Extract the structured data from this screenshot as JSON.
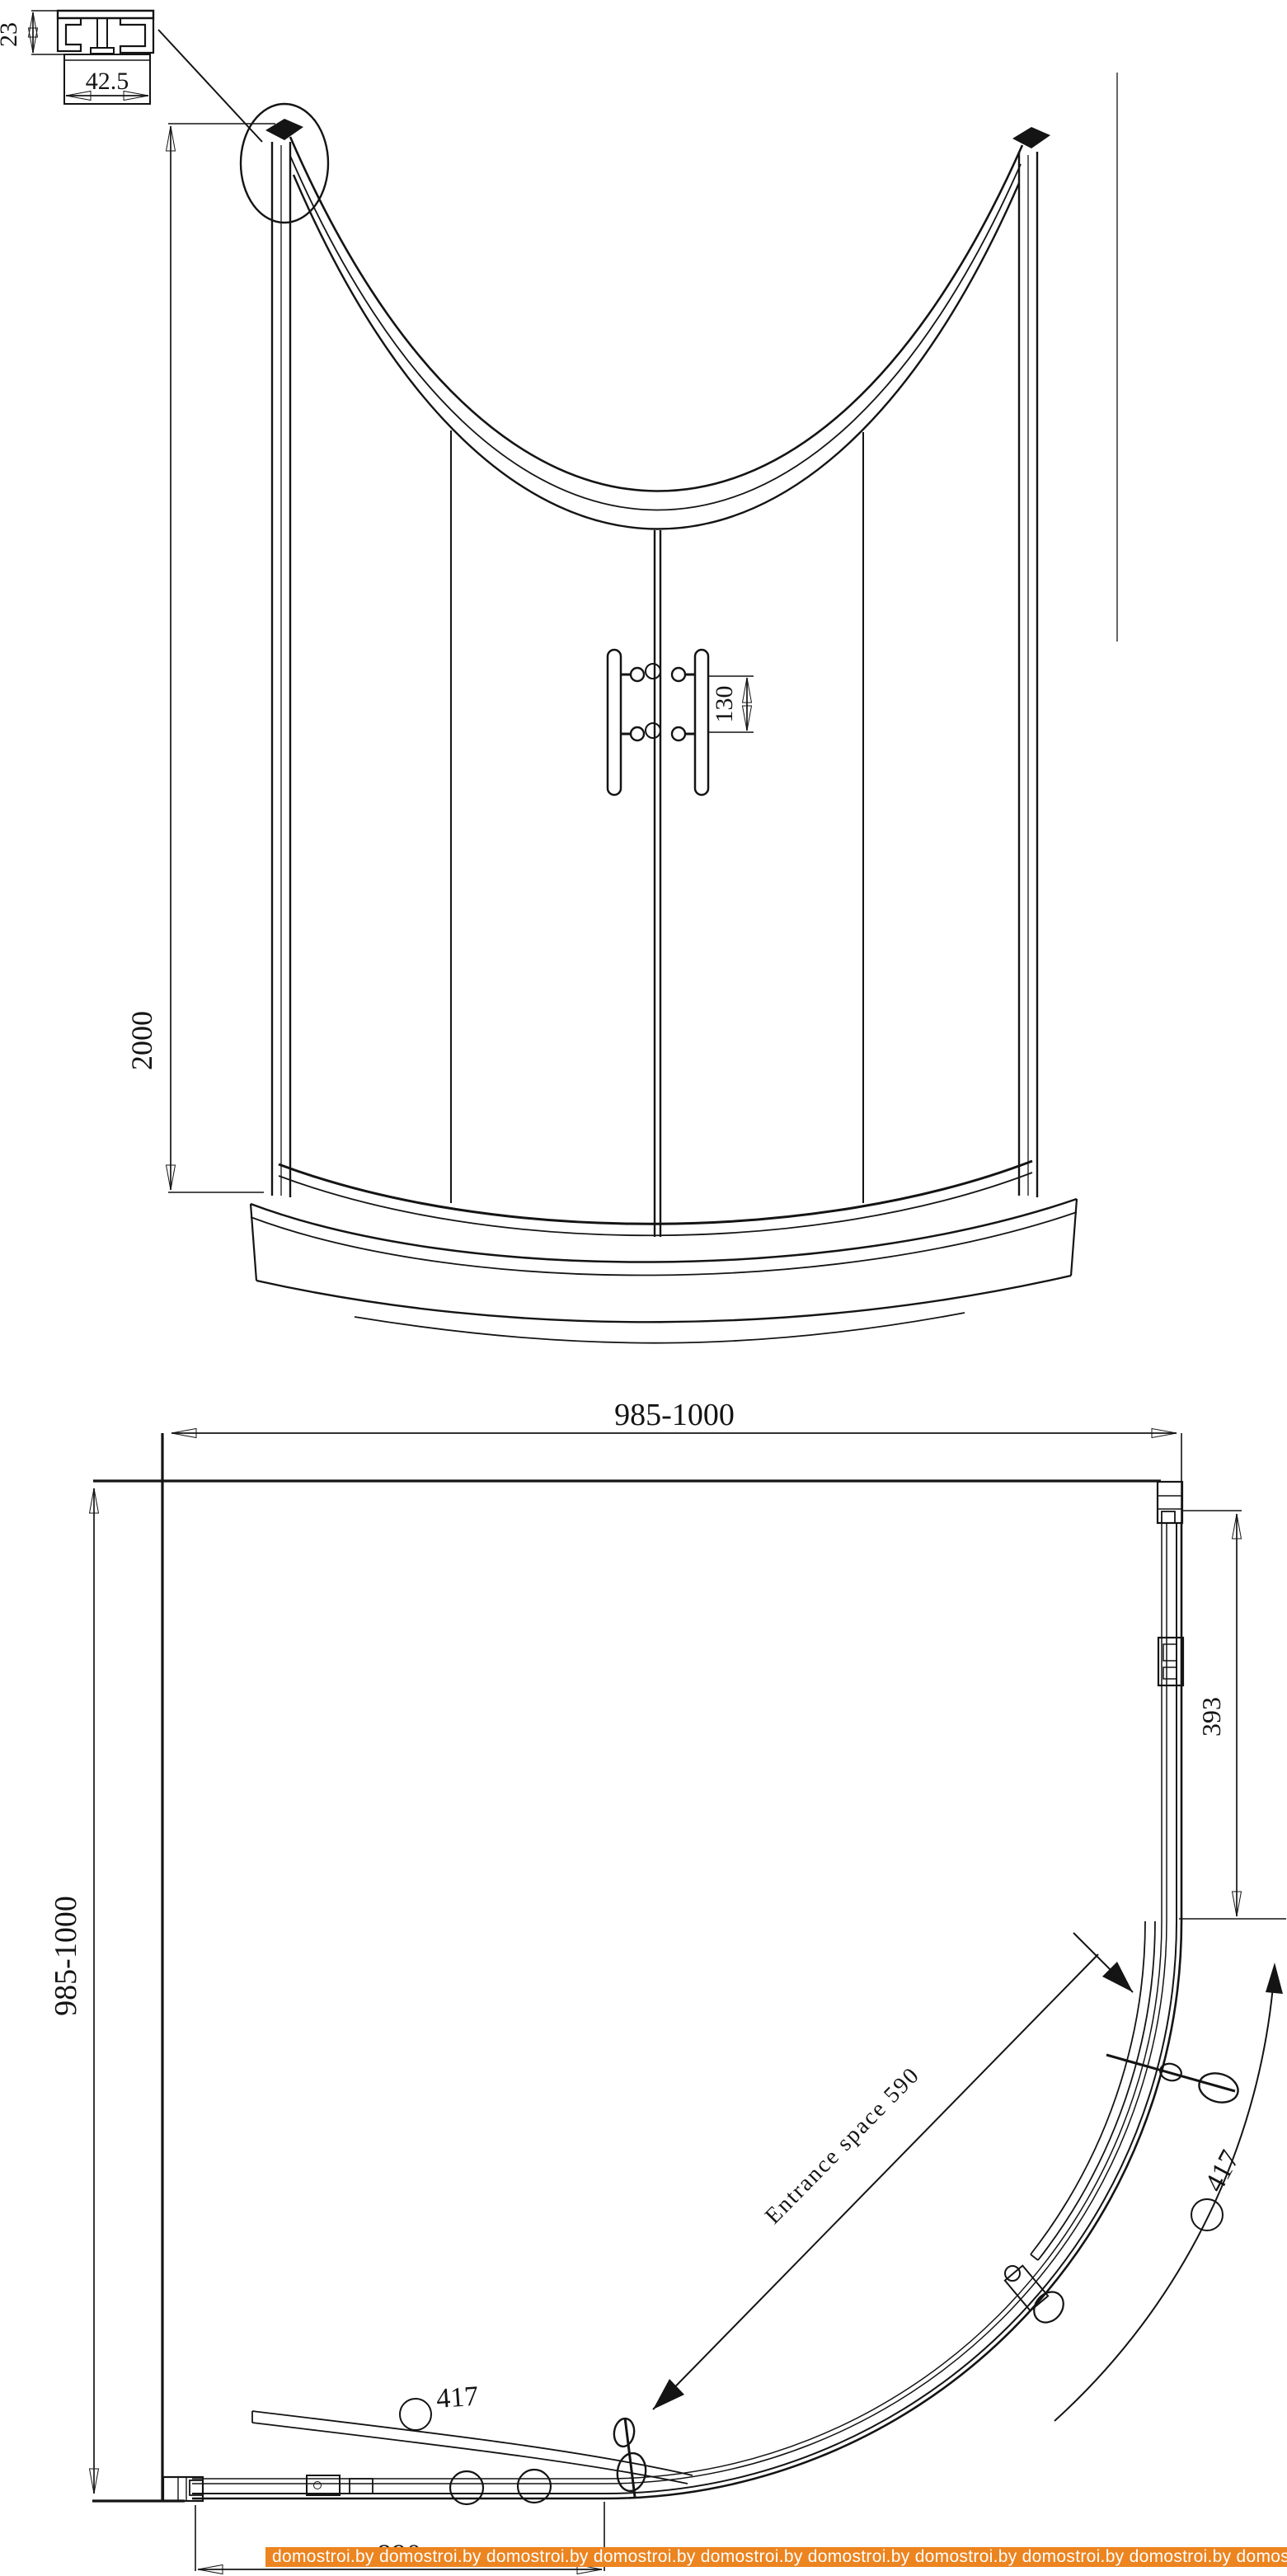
{
  "page": {
    "background": "#ffffff",
    "line_color": "#141414"
  },
  "profile_detail": {
    "height_mm": "23",
    "width_mm": "42.5"
  },
  "front_view": {
    "overall_height_mm": "2000",
    "handle_pitch_mm": "130"
  },
  "plan_view": {
    "overall_width_mm": "985-1000",
    "overall_depth_mm": "985-1000",
    "side_straight_mm": "393",
    "entrance_note": "Entrance space 590",
    "curved_panel_right_mm": "417",
    "curved_panel_bottom_mm": "417",
    "bottom_partial_mm": "890"
  },
  "watermark": {
    "text": "domostroi.by",
    "repeats": 10,
    "background": "#ec8420",
    "text_color": "#ffffff"
  }
}
